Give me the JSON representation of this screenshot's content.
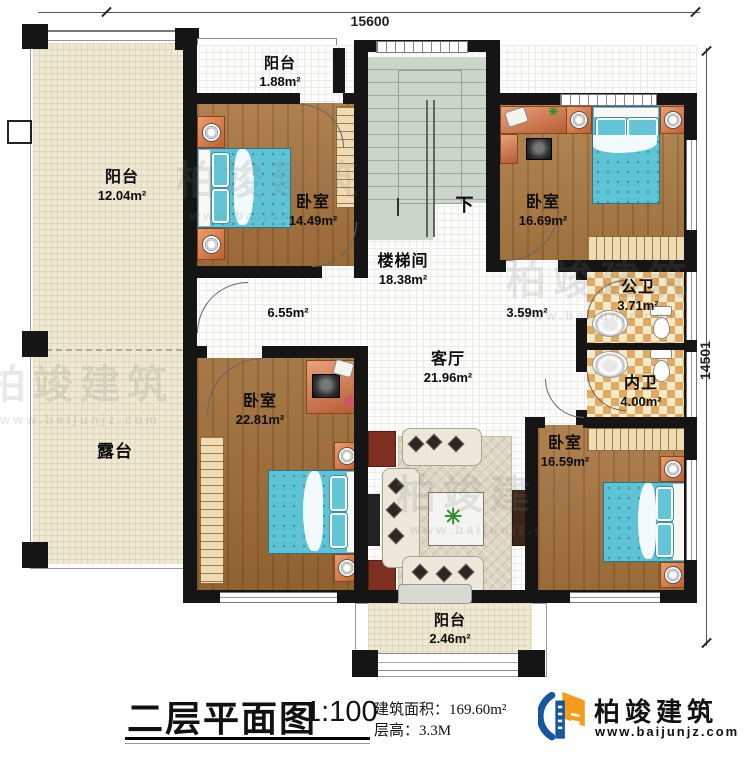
{
  "dimensions": {
    "width_top": "15600",
    "height_right": "14501"
  },
  "rooms": {
    "balcony_top": {
      "name": "阳台",
      "area": "1.88m²"
    },
    "balcony_left": {
      "name": "阳台",
      "area": "12.04m²"
    },
    "terrace": {
      "name": "露台"
    },
    "bedroom_top_left": {
      "name": "卧室",
      "area": "14.49m²"
    },
    "bedroom_top_right": {
      "name": "卧室",
      "area": "16.69m²"
    },
    "stair_hall": {
      "name": "楼梯间",
      "area": "18.38m²"
    },
    "hall_west": {
      "area": "6.55m²"
    },
    "hall_east": {
      "area": "3.59m²"
    },
    "living_room": {
      "name": "客厅",
      "area": "21.96m²"
    },
    "public_bathroom": {
      "name": "公卫",
      "area": "3.71m²"
    },
    "private_bathroom": {
      "name": "内卫",
      "area": "4.00m²"
    },
    "bedroom_bottom_left": {
      "name": "卧室",
      "area": "22.81m²"
    },
    "bedroom_bottom_right": {
      "name": "卧室",
      "area": "16.59m²"
    },
    "balcony_bottom": {
      "name": "阳台",
      "area": "2.46m²"
    },
    "stair_direction": "下"
  },
  "title_block": {
    "title": "二层平面图",
    "scale": "1:100",
    "area_label": "建筑面积：",
    "area_value": "169.60m²",
    "floor_height_label": "层高：",
    "floor_height_value": "3.3M"
  },
  "logo": {
    "company": "柏竣建筑",
    "website": "www.baijunjz.com"
  },
  "watermark": {
    "text": "柏竣建筑",
    "subtext": "www.baijunjz.com"
  },
  "colors": {
    "wall": "#151515",
    "wood_floor": "#a6733c",
    "tile": "#dfab64",
    "stair": "#ccd5ca",
    "balcony": "#efe8d3",
    "bed": "#5fc3d6",
    "accent_blue": "#15579f",
    "accent_orange": "#f59c1c"
  }
}
